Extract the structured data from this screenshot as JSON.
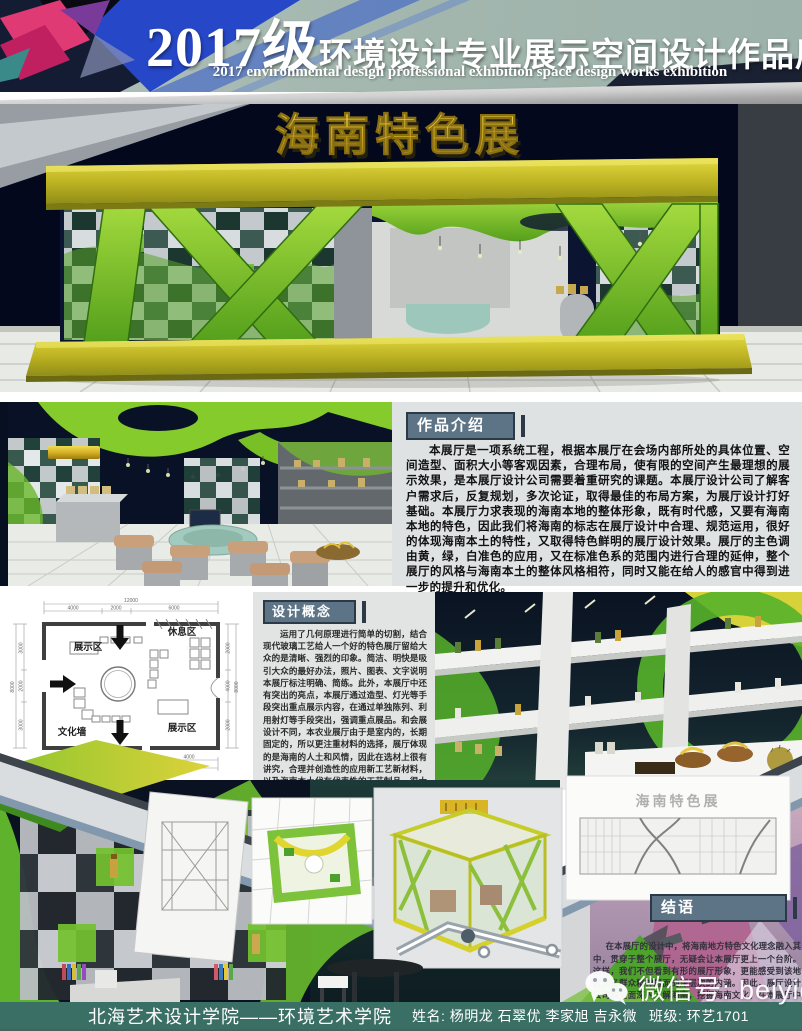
{
  "header": {
    "title_year": "2017级",
    "title_cn": "环境设计专业展示空间设计作品展",
    "subtitle_en": "2017 environmental design professional exhibition space design works exhibition"
  },
  "main_render": {
    "sign_text": "海南特色展"
  },
  "intro": {
    "title": "作品介绍",
    "body": "本展厅是一项系统工程，根据本展厅在会场内部所处的具体位置、空间造型、面积大小等客观因素，合理布局，使有限的空间产生最理想的展示效果，是本展厅设计公司需要着重研究的课题。本展厅设计公司了解客户需求后，反复规划，多次论证，取得最佳的布局方案，为展厅设计打好基础。本展厅力求表现的海南本地的整体形象，既有时代感，又要有海南本地的特色，因此我们将海南的标志在展厅设计中合理、规范运用，很好的体现海南本土的特性，又取得特色鲜明的展厅设计效果。展厅的主色调由黄，绿，白准色的应用，又在标准色系的范围内进行合理的延伸，整个展厅的风格与海南本土的整体风格相符，同时又能在给人的感官中得到进一步的提升和优化。"
  },
  "concept": {
    "title": "设计概念",
    "body": "运用了几何原理进行简单的切割，结合现代玻璃工艺给人一个好的特色展厅留给大众的是清晰、强烈的印象。简洁、明快是吸引大众的最好办法，照片、图表、文字说明本展厅标注明确、简练。此外，本展厅中还有突出的亮点，本展厅通过造型、灯光等手段突出重点展示内容，在通过单独陈列、利用射灯等手段突出，强调重点展品。和会展设计不同，本农业展厅由于是室内的，长期固定的，所以更注重材料的选择，展厅体现的是海南的人土和风情，因此在选材上很有讲究，合理并创造性的应用新工艺新材料，以及海南本土代有代表性的工艺制品，很大程度上会提升展厅的整体效果。不像会展空间，基本只能选择一些简单的饰面。"
  },
  "conclusion": {
    "title": "结语",
    "body": "在本展厅的设计中，将海南地方特色文化理念融入其中，贯穿于整个展厅，无疑会让本展厅更上一个台阶。这样，我们不但看到有形的展厅形象，更能感受到该地区人名群众精神层面的深层次的内涵。因此，展厅设计公司应全面深入了解海南，挖掘海南文化，在本展厅中有血有肉地呈现给大家。"
  },
  "floor_plan": {
    "labels": {
      "top_left": "展示区",
      "top_right": "休息区",
      "bottom_left": "文化墙",
      "bottom_right": "展示区"
    },
    "dims": {
      "top_total": "12000",
      "top": [
        "4000",
        "2000",
        "6000"
      ],
      "bottom": [
        "6000",
        "2000",
        "4000"
      ],
      "bottom_total": "12000",
      "left_total": "8000",
      "left": [
        "3000",
        "2000",
        "3000"
      ],
      "right_total": "8000",
      "right": [
        "2000",
        "4000",
        "2000"
      ]
    }
  },
  "sketch_caption": "海南特色展",
  "watermark": {
    "label": "微信号: beiyigw"
  },
  "footer": {
    "school": "北海艺术设计学院——环境艺术学院",
    "names": "姓名: 杨明龙 石翠优 李家旭 吉永微",
    "class_label": "班级: 环艺1701"
  },
  "colors": {
    "accent_green": "#74c12f",
    "accent_yellow": "#d8cf30",
    "badge_slate": "#5d7487",
    "footer_teal": "#3a6f65",
    "header_sage": "#a2b6ae",
    "header_navy": "#141c33"
  }
}
